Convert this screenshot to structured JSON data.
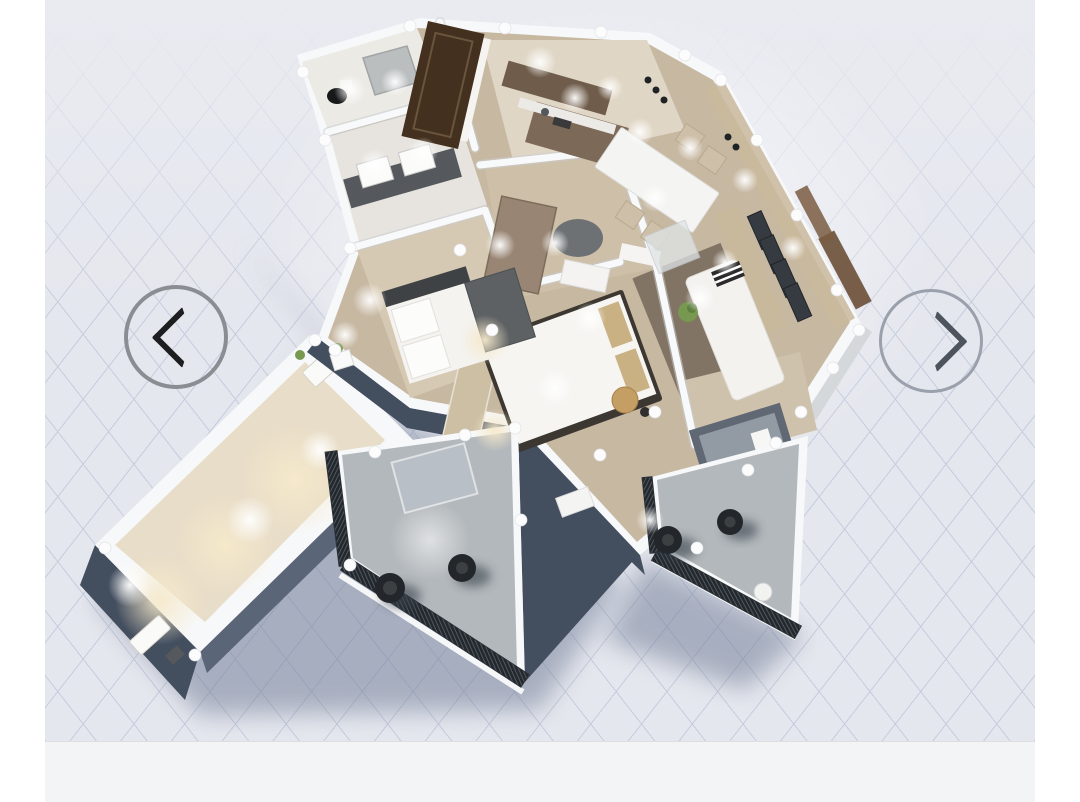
{
  "scene": {
    "aria_label": "3D isometric rendering of an apartment floor plan with kitchen, dining area, living room, two bedrooms, bathroom, laundry, hallway, a long lit terrace wing and two balconies with lounge chairs, casting a shadow on a light grid floor"
  },
  "carousel": {
    "prev_label": "Previous view",
    "prev_icon": "chevron-left-icon",
    "next_label": "Next view",
    "next_icon": "chevron-right-icon"
  },
  "colors": {
    "page_bg": "#ffffff",
    "grid_bg": "#e5e7ee",
    "grid_line": "#c6ccdd",
    "grid_fade": "#e9ebf1",
    "bottom_strip": "#f2f4f6",
    "strip_border": "#dcdee2",
    "shadow": "#76819a",
    "wall_white": "#f7f8f9",
    "wood": "#c7b8a2",
    "wood_light": "#d8ccb8",
    "slate": "#5a6577",
    "slate_dark": "#434e5f",
    "balcony_floor": "#b3b8bc",
    "beige_wall": "#c9b99c",
    "warm_light": "#f6e9cb",
    "cabinet_brown": "#7c6957",
    "door_brown": "#43301f",
    "railing": "#23282d",
    "chair_black": "#23272b",
    "rug": "#6b5e50",
    "mirror": "#6d7174",
    "table_wood": "#c59e63",
    "plant_green": "#76994f",
    "arrow_ring": "#8a8d92",
    "arrow_ring_faint": "#9aa1ac",
    "chevron": "#1c1e20",
    "chevron_faint": "#4d545e"
  }
}
